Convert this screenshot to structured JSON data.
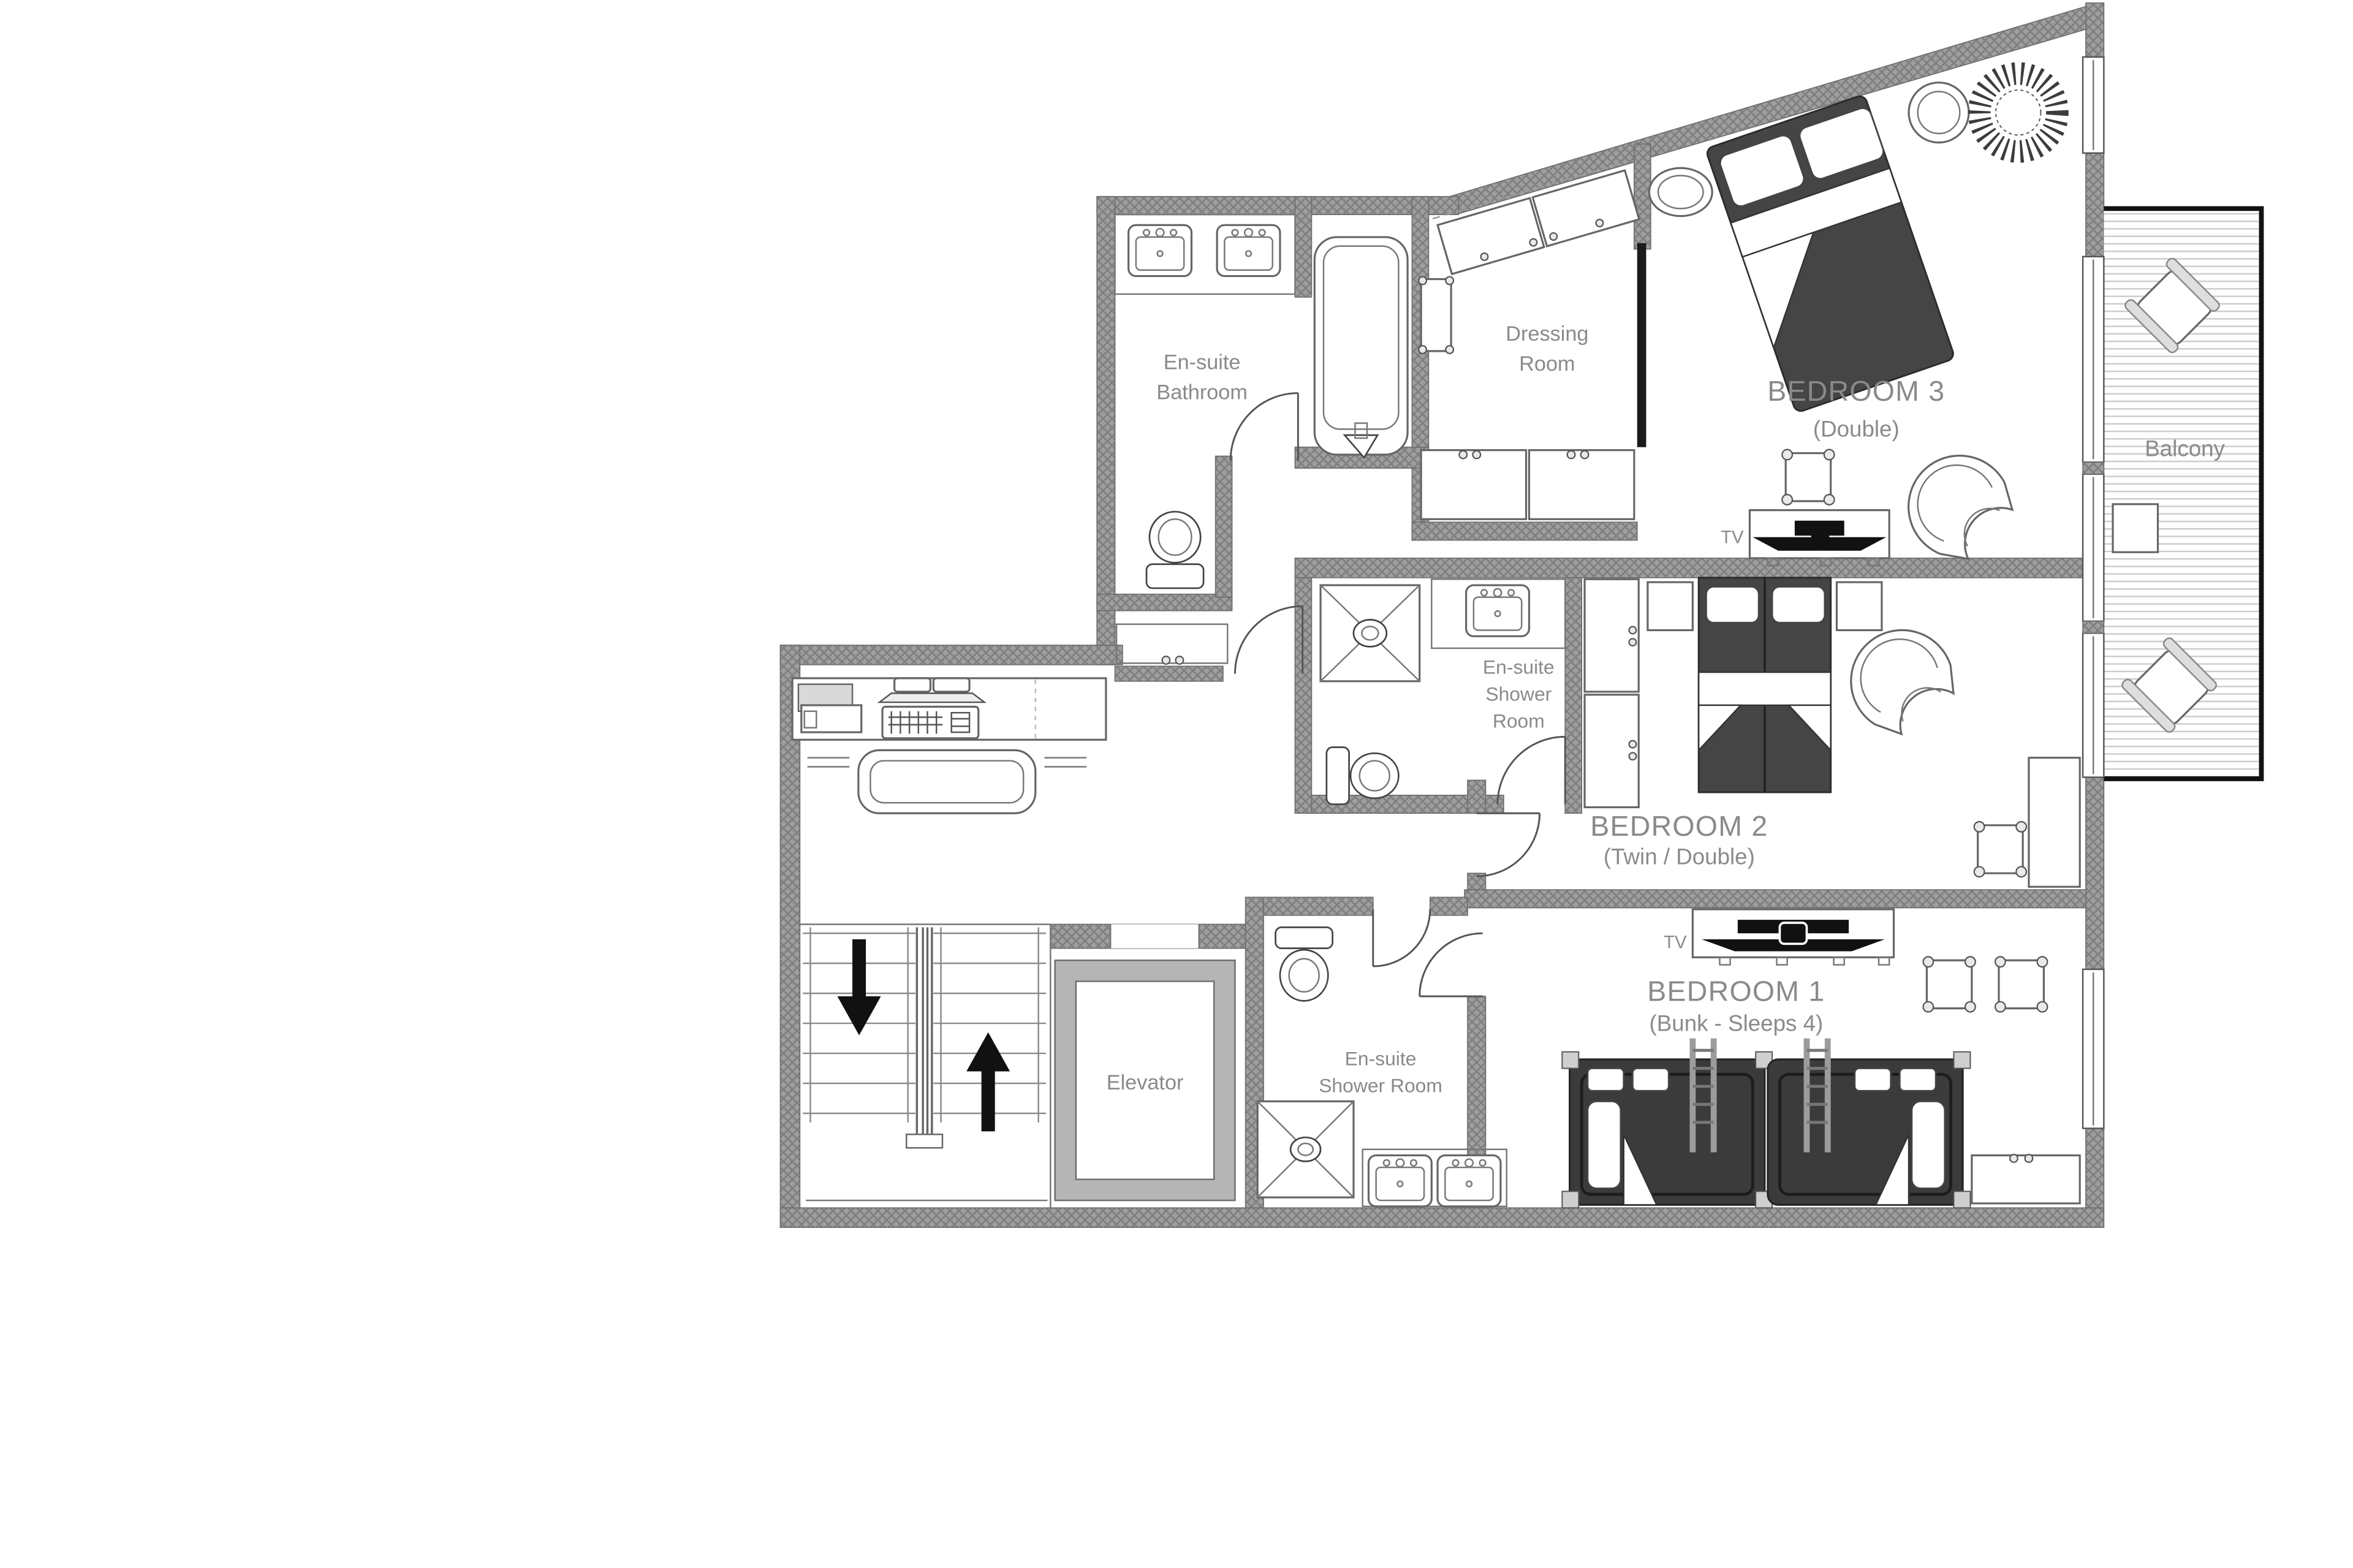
{
  "plan_title": "Apartment floor plan",
  "rooms": {
    "bedroom3": {
      "title": "BEDROOM 3",
      "subtitle": "(Double)"
    },
    "bedroom2": {
      "title": "BEDROOM 2",
      "subtitle": "(Twin / Double)"
    },
    "bedroom1": {
      "title": "BEDROOM 1",
      "subtitle": "(Bunk - Sleeps 4)"
    },
    "balcony": {
      "title": "Balcony"
    },
    "elevator": {
      "title": "Elevator"
    },
    "dressing_room": {
      "line1": "Dressing",
      "line2": "Room"
    },
    "ensuite_bathroom": {
      "line1": "En-suite",
      "line2": "Bathroom"
    },
    "ensuite_shower_bedroom2": {
      "line1": "En-suite",
      "line2": "Shower",
      "line3": "Room"
    },
    "ensuite_shower_bedroom1": {
      "line1": "En-suite",
      "line2": "Shower Room"
    }
  },
  "labels": {
    "tv_bedroom3": "TV",
    "tv_bedroom1": "TV"
  },
  "colors": {
    "wall": "#9e9e9e",
    "wall_hatch": "#7f7f7f",
    "outline": "#5f5f5f",
    "furniture_dark": "#454545",
    "label_text": "#8a8a8a",
    "elevator_frame": "#b5b5b5",
    "balcony_border": "#111111",
    "deck_line": "#cccccc",
    "arrow": "#111111",
    "background": "#ffffff"
  },
  "icons": [
    "double-bed-icon",
    "twin-bed-icon",
    "bunk-bed-icon",
    "bathtub-icon",
    "toilet-icon",
    "sink-icon",
    "shower-tray-icon",
    "wardrobe-icon",
    "stool-icon",
    "armchair-icon",
    "sunburst-rug-icon",
    "tv-icon",
    "stairs-icon",
    "up-arrow-icon",
    "down-arrow-icon",
    "desk-icon",
    "keyboard-icon",
    "monitor-icon",
    "printer-icon",
    "sofa-icon",
    "balcony-chair-icon",
    "side-table-icon",
    "window",
    "door-arc"
  ]
}
